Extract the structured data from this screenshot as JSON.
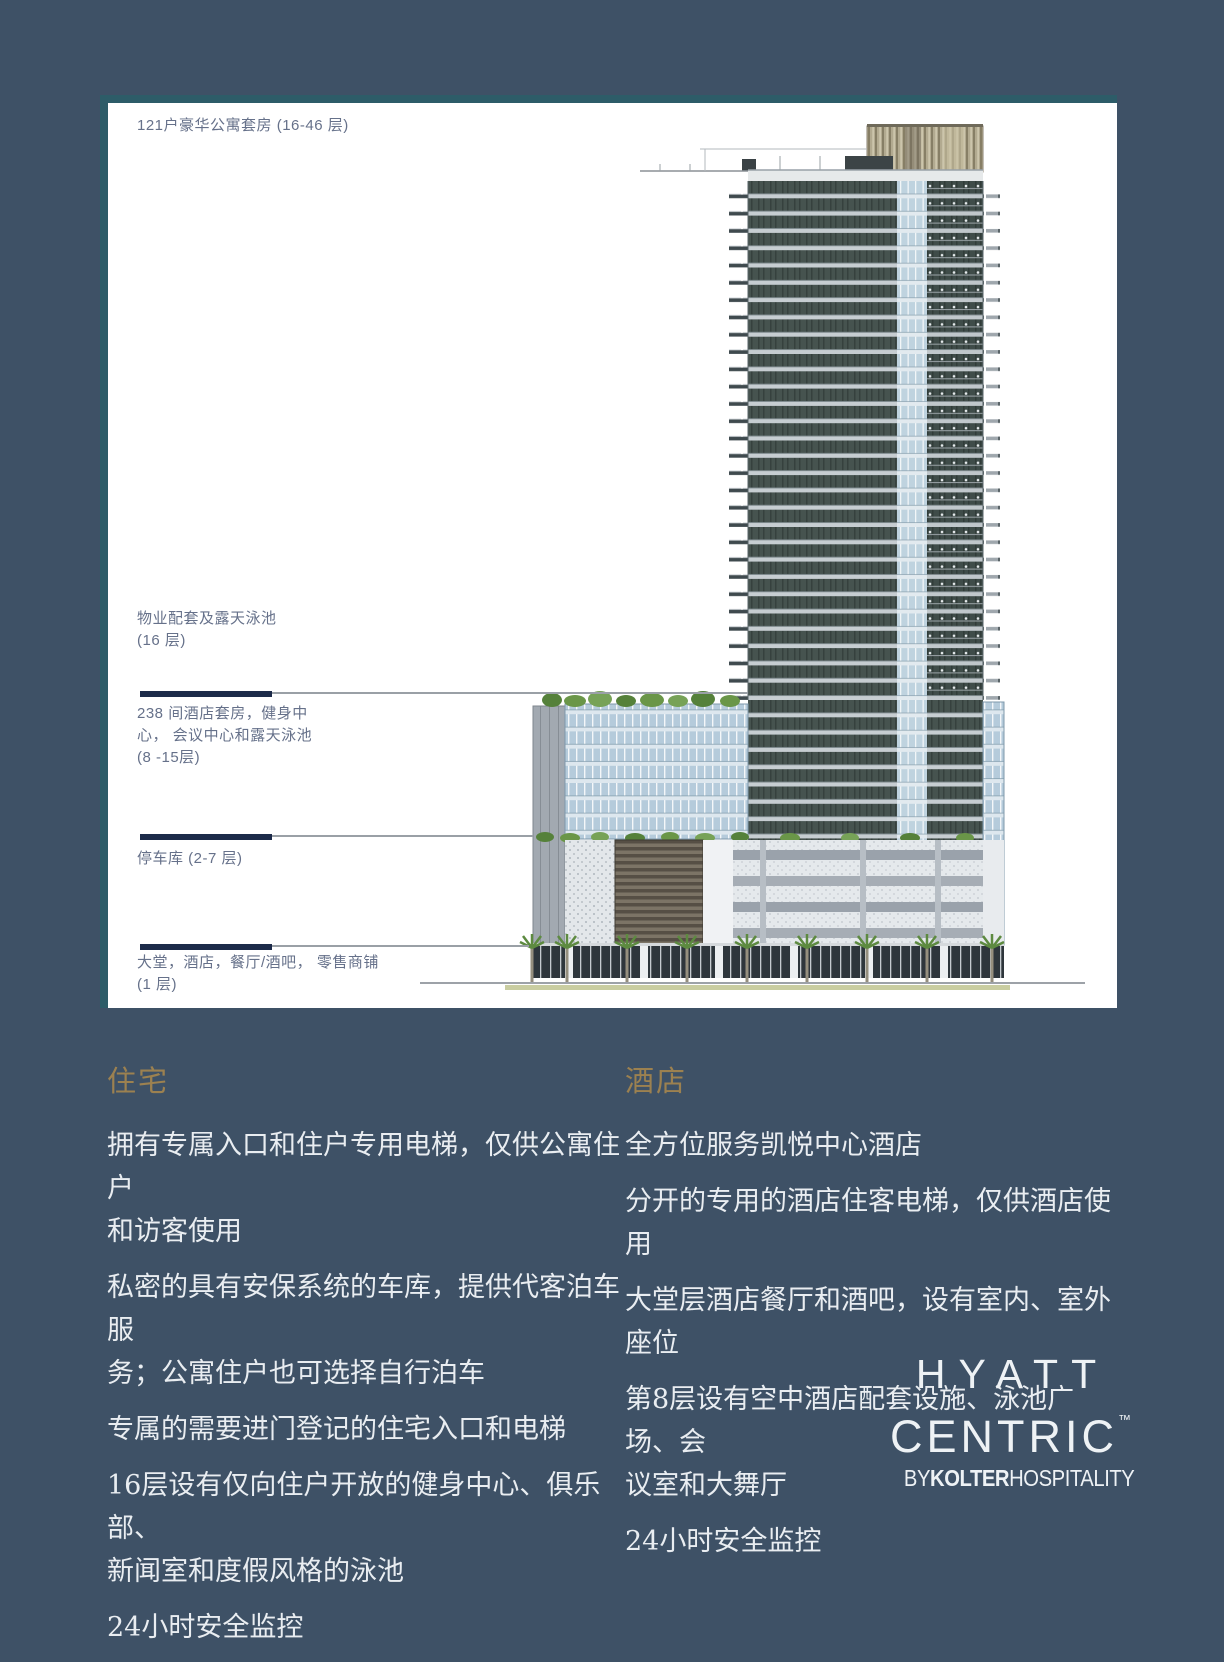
{
  "page": {
    "background": "#3e5166",
    "panel_background": "#ffffff",
    "accent_gold": "#9c8150",
    "body_text_color": "#e9edf1",
    "diagram_label_color": "#66718a",
    "leader_thick_color": "#1d2b4a",
    "leader_thin_color": "#9aa0a6"
  },
  "diagram": {
    "labels": [
      {
        "text": "121户豪华公寓套房 (16-46 层)"
      },
      {
        "text": "物业配套及露天泳池\n(16 层)"
      },
      {
        "text": "238 间酒店套房，健身中\n心， 会议中心和露天泳池\n(8 -15层)"
      },
      {
        "text": "停车库 (2-7 层)"
      },
      {
        "text": "大堂，酒店，餐厅/酒吧， 零售商铺\n(1 层)"
      }
    ]
  },
  "sections": {
    "residences": {
      "title": "住宅",
      "paragraphs": [
        "拥有专属入口和住户专用电梯，仅供公寓住户\n和访客使用",
        "私密的具有安保系统的车库，提供代客泊车服\n务；公寓住户也可选择自行泊车",
        "专属的需要进门登记的住宅入口和电梯",
        "16层设有仅向住户开放的健身中心、俱乐部、\n新闻室和度假风格的泳池",
        "24小时安全监控"
      ]
    },
    "hotel": {
      "title": "酒店",
      "paragraphs": [
        "全方位服务凯悦中心酒店",
        "分开的专用的酒店住客电梯，仅供酒店使用",
        "大堂层酒店餐厅和酒吧，设有室内、室外座位",
        "第8层设有空中酒店配套设施、泳池广场、会\n议室和大舞厅",
        "24小时安全监控"
      ]
    }
  },
  "logo": {
    "line1": "HYATT",
    "line2": "CENTRIC",
    "tm": "™",
    "by_prefix": "BY",
    "by_bold": "KOLTER",
    "by_suffix": "HOSPITALITY"
  }
}
